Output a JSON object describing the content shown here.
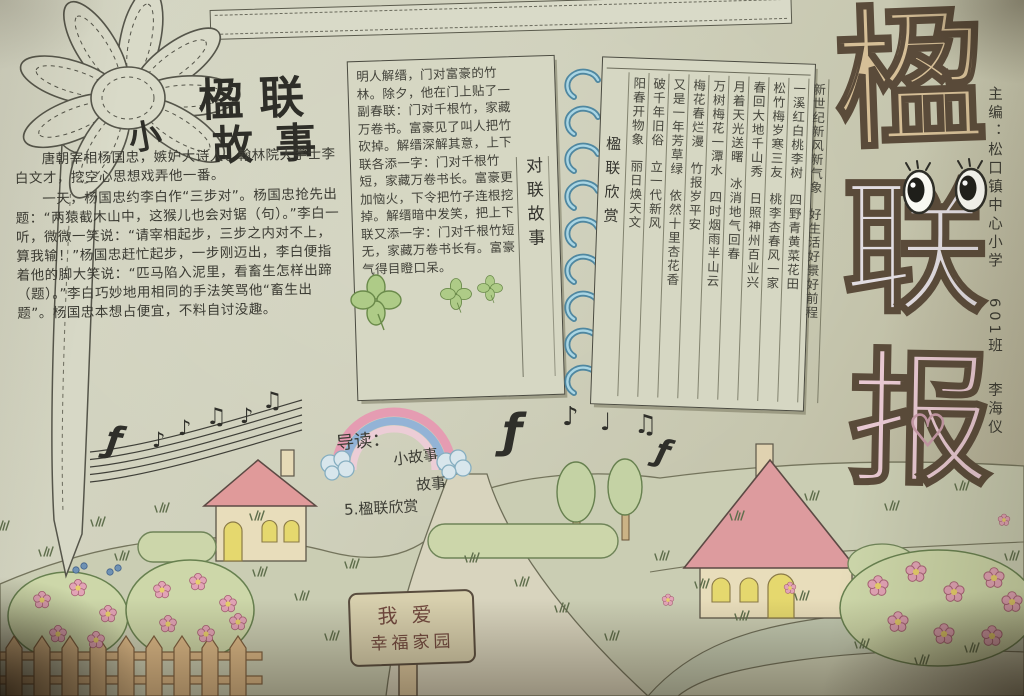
{
  "photo": {
    "masthead": {
      "chars": [
        "楹",
        "联",
        "报"
      ],
      "heart_glyph": "♡",
      "edition_lines": [
        "主编：松口镇中心小学",
        "601班",
        "李海仪"
      ]
    },
    "story": {
      "title_prefix": "小",
      "title_line1": "楹联",
      "title_line2": "故事",
      "paragraph1": "唐朝宰相杨国忠，嫉妒大诗人、翰林院大学士李白文才，挖空心思想戏弄他一番。",
      "paragraph2": "一天，杨国忠约李白作“三步对”。杨国忠抢先出题：“两猿截木山中，这猴儿也会对锯（句）。”李白一听，微微一笑说：“请宰相起步，三步之内对不上，算我输！”杨国忠赶忙起步，一步刚迈出，李白便指着他的脚大笑说：“匹马陷入泥里，看畜生怎样出蹄（题）。”李白巧妙地用相同的手法笑骂他“畜生出题”。杨国忠本想占便宜，不料自讨没趣。"
    },
    "notebook": {
      "left_page_text": "明人解缙，门对富豪的竹林。除夕，他在门上贴了一副春联：门对千根竹，家藏万卷书。富豪见了叫人把竹砍掉。解缙深解其意，上下联各添一字：门对千根竹短，家藏万卷书长。富豪更加恼火，下令把竹子连根挖掉。解缙暗中发笑，把上下联又添一字：门对千根竹短无，家藏万卷书长有。富豪气得目瞪口呆。",
      "left_page_label": "对联故事",
      "right_page_label": "楹联欣赏",
      "couplets": [
        {
          "first": "阳春开物象",
          "second": "丽日焕天文"
        },
        {
          "first": "破千年旧俗",
          "second": "立一代新风"
        },
        {
          "first": "又是一年芳草绿",
          "second": "依然十里杏花香"
        },
        {
          "first": "梅花春烂漫",
          "second": "竹报岁平安"
        },
        {
          "first": "万树梅花一潭水",
          "second": "四时烟雨半山云"
        },
        {
          "first": "月着天光送曙",
          "second": "冰消地气回春"
        },
        {
          "first": "春回大地千山秀",
          "second": "日照神州百业兴"
        },
        {
          "first": "松竹梅岁寒三友",
          "second": "桃李杏春风一家"
        },
        {
          "first": "一溪红白桃李树",
          "second": "四野青黄菜花田"
        },
        {
          "first": "新世纪新风新气象",
          "second": "好生活好景好前程"
        }
      ]
    },
    "guide": {
      "lines": [
        "导读：",
        "小故事",
        "故事",
        "5.楹联欣赏"
      ]
    },
    "sign": {
      "line1": "我爱",
      "line2": "幸福家园"
    },
    "music": {
      "clef_glyph": "ƒ",
      "staff_notes": [
        "♪",
        "♪",
        "♫",
        "♪",
        "♫"
      ],
      "floating_notes": [
        "♪",
        "♩",
        "♫"
      ]
    },
    "colors": {
      "paper": "#cccdb8",
      "ink": "#3b3b33",
      "masthead_tan": "#d6bf97",
      "masthead_pink": "#e9c9d3",
      "spiral_blue": "#4f87a0",
      "roof_pink": "#dd9b9e",
      "window_yellow": "#e5d86e",
      "leaf_green": "#cdd7a9",
      "flower_pink": "#e2a4b6"
    }
  }
}
